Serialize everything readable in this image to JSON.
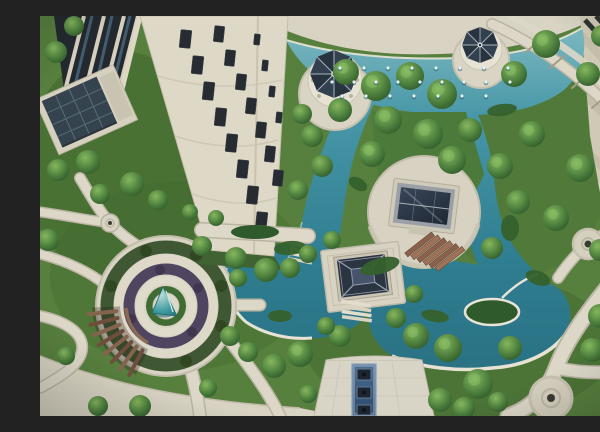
{
  "meta": {
    "title": "Aerial view of a landscaped residential courtyard",
    "description": "Bird's-eye photograph of an apartment-complex courtyard: turquoise ornamental pools and canals, two dark-roofed pavilions on stone platforms joined by brick steps, two white gazebos with dark conical roofs beside an upper fountain pool with tree islands, a circular plaza with a teal spiral sculpture and curved wooden pergola, winding cream stone paths with circular nodes, lawns and clipped shrubs, a cream high-rise tower with dark windows at upper left, a glass curtain-wall facade and a solar-panel roofed clubhouse on the left, and stone terraces of another building on the right."
  },
  "palette": {
    "water_light": "#7cb8c0",
    "water": "#3c8a9c",
    "water_deep": "#276d7e",
    "lawn": "#577f3e",
    "lawn_dark": "#41682f",
    "path": "#dcd7c7",
    "stone_band": "#d8d3c2",
    "terrace": "#cfc9b6",
    "tower_facade": "#ded8c6",
    "window_dark": "#272c33",
    "roof_dark": "#2a333f",
    "gazebo_roof": "#2c3a49",
    "wood_pergola": "#6f4f3c",
    "brick_steps": "#8a604b",
    "plant_purple": "#4f4560",
    "sculpture_teal": "#2e8f96",
    "runnel_blue": "#2b4a6b"
  },
  "scene": {
    "landmarks": [
      {
        "name": "high-rise-tower",
        "label": "Cream residential tower with dark window strips"
      },
      {
        "name": "glass-facade",
        "label": "Dark glass curtain-wall of adjacent block"
      },
      {
        "name": "solar-roof-clubhouse",
        "label": "Low clubhouse with dark panel roof"
      },
      {
        "name": "upper-pool",
        "label": "Large turquoise pool with fountain jets"
      },
      {
        "name": "gazebo-left",
        "label": "White gazebo, dark conical roof"
      },
      {
        "name": "gazebo-right",
        "label": "White gazebo, dark conical roof"
      },
      {
        "name": "tree-islands",
        "label": "Row of trees on islands in the pool"
      },
      {
        "name": "canals",
        "label": "Twin canals flowing down from the pool"
      },
      {
        "name": "upper-pavilion",
        "label": "Flat dark-roofed pavilion on round stone platform"
      },
      {
        "name": "lower-pavilion",
        "label": "Pyramid dark-roofed pavilion on stone platform"
      },
      {
        "name": "brick-steps",
        "label": "Red-brown terraced steps between pavilions"
      },
      {
        "name": "left-pond",
        "label": "Scallop-edged pond west of pavilions"
      },
      {
        "name": "right-pond",
        "label": "Large organic pond east of pavilions"
      },
      {
        "name": "pond-island",
        "label": "Planted island with white rim"
      },
      {
        "name": "circular-plaza",
        "label": "Concentric-ring plaza with purple planting"
      },
      {
        "name": "spiral-sculpture",
        "label": "Teal cone sculpture at plaza centre"
      },
      {
        "name": "wooden-pergola",
        "label": "Curved timber pergola / bench arc"
      },
      {
        "name": "walkway-bridge",
        "label": "Stone walkway with planter crossing the canal"
      },
      {
        "name": "stepping-bridge",
        "label": "White plank steps across pond"
      },
      {
        "name": "promenade",
        "label": "Wide paved promenade along bottom edge"
      },
      {
        "name": "path-nodes",
        "label": "Circular path hubs with centre drains"
      },
      {
        "name": "water-runnel",
        "label": "Blue water-feature runnel with three basins"
      },
      {
        "name": "right-terrace",
        "label": "Stone terraces of the right-hand building"
      },
      {
        "name": "garden-arc-path",
        "label": "Curved slab path in upper-right garden"
      }
    ]
  },
  "vegetation": {
    "trees": [
      [
        306,
        56,
        13
      ],
      [
        336,
        70,
        15
      ],
      [
        370,
        60,
        14
      ],
      [
        402,
        78,
        15
      ],
      [
        348,
        104,
        14
      ],
      [
        388,
        118,
        15
      ],
      [
        332,
        138,
        13
      ],
      [
        412,
        144,
        14
      ],
      [
        300,
        94,
        12
      ],
      [
        430,
        114,
        12
      ],
      [
        272,
        120,
        11
      ],
      [
        282,
        150,
        11
      ],
      [
        258,
        174,
        10
      ],
      [
        262,
        98,
        10
      ],
      [
        474,
        58,
        13
      ],
      [
        506,
        28,
        14
      ],
      [
        548,
        58,
        12
      ],
      [
        574,
        106,
        13
      ],
      [
        540,
        152,
        14
      ],
      [
        516,
        202,
        13
      ],
      [
        578,
        182,
        12
      ],
      [
        492,
        118,
        13
      ],
      [
        460,
        150,
        13
      ],
      [
        478,
        186,
        12
      ],
      [
        560,
        234,
        11
      ],
      [
        596,
        146,
        10
      ],
      [
        562,
        20,
        11
      ],
      [
        592,
        62,
        10
      ],
      [
        560,
        300,
        12
      ],
      [
        590,
        320,
        11
      ],
      [
        552,
        334,
        12
      ],
      [
        376,
        320,
        13
      ],
      [
        408,
        332,
        14
      ],
      [
        438,
        368,
        15
      ],
      [
        470,
        332,
        12
      ],
      [
        300,
        320,
        11
      ],
      [
        260,
        338,
        13
      ],
      [
        234,
        350,
        12
      ],
      [
        424,
        392,
        11
      ],
      [
        458,
        386,
        10
      ],
      [
        400,
        384,
        12
      ],
      [
        286,
        310,
        9
      ],
      [
        356,
        302,
        10
      ],
      [
        374,
        278,
        9
      ],
      [
        292,
        224,
        9
      ],
      [
        268,
        238,
        9
      ],
      [
        452,
        232,
        11
      ],
      [
        16,
        36,
        11
      ],
      [
        34,
        10,
        10
      ],
      [
        48,
        146,
        12
      ],
      [
        18,
        154,
        11
      ],
      [
        8,
        224,
        11
      ],
      [
        92,
        168,
        12
      ],
      [
        118,
        184,
        10
      ],
      [
        60,
        178,
        10
      ],
      [
        162,
        230,
        10
      ],
      [
        196,
        242,
        11
      ],
      [
        226,
        254,
        12
      ],
      [
        250,
        252,
        10
      ],
      [
        198,
        262,
        9
      ],
      [
        190,
        320,
        10
      ],
      [
        208,
        336,
        10
      ],
      [
        100,
        390,
        11
      ],
      [
        58,
        390,
        10
      ],
      [
        26,
        340,
        9
      ],
      [
        168,
        372,
        9
      ],
      [
        268,
        378,
        9
      ],
      [
        150,
        196,
        8
      ],
      [
        176,
        202,
        8
      ]
    ],
    "shrub_beds": [
      [
        340,
        250,
        20,
        8,
        -15
      ],
      [
        250,
        232,
        16,
        7,
        -5
      ],
      [
        498,
        262,
        13,
        7,
        20
      ],
      [
        462,
        94,
        15,
        6,
        -8
      ],
      [
        470,
        212,
        9,
        13,
        0
      ],
      [
        318,
        168,
        10,
        6,
        30
      ],
      [
        240,
        300,
        12,
        6,
        0
      ],
      [
        395,
        300,
        14,
        6,
        10
      ]
    ]
  },
  "fountain": {
    "jet_rows": [
      {
        "y": 52,
        "xs": [
          300,
          324,
          348,
          372,
          396,
          420,
          444,
          468
        ]
      },
      {
        "y": 66,
        "xs": [
          292,
          314,
          336,
          358,
          380,
          402,
          424,
          446,
          470
        ]
      },
      {
        "y": 80,
        "xs": [
          302,
          326,
          350,
          374,
          398,
          422,
          446
        ]
      }
    ]
  },
  "tower": {
    "windows": [
      [
        140,
        14,
        11,
        18
      ],
      [
        152,
        40,
        11,
        18
      ],
      [
        163,
        66,
        11,
        18
      ],
      [
        175,
        92,
        11,
        18
      ],
      [
        186,
        118,
        11,
        18
      ],
      [
        197,
        144,
        11,
        18
      ],
      [
        207,
        170,
        11,
        18
      ],
      [
        216,
        196,
        11,
        18
      ],
      [
        174,
        10,
        10,
        16
      ],
      [
        185,
        34,
        10,
        16
      ],
      [
        196,
        58,
        10,
        16
      ],
      [
        206,
        82,
        10,
        16
      ],
      [
        216,
        106,
        10,
        16
      ],
      [
        225,
        130,
        10,
        16
      ],
      [
        233,
        154,
        10,
        16
      ],
      [
        214,
        18,
        6,
        11
      ],
      [
        222,
        44,
        6,
        11
      ],
      [
        229,
        70,
        6,
        11
      ],
      [
        236,
        96,
        6,
        11
      ]
    ]
  },
  "pergola": {
    "cx": 126,
    "cy": 290,
    "r_inner": 50,
    "r_outer": 78,
    "angles_deg": [
      118,
      126,
      134,
      142,
      150,
      158,
      166,
      174
    ]
  }
}
